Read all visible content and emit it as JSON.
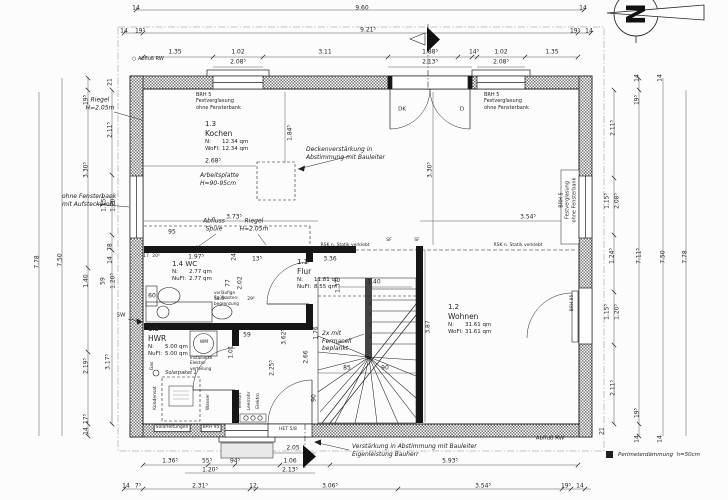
{
  "colors": {
    "ink": "#1f1f1f",
    "hatch": "#7a7a7a",
    "lightwell": "#e9e9e9"
  },
  "north": {
    "label": "N"
  },
  "legend": {
    "text": "Perimeterdämmung  h=50cm"
  },
  "rooms": [
    {
      "num": "1.3",
      "name": "Kochen",
      "inline": false,
      "x": 205,
      "y": 120,
      "rows": [
        [
          "N:",
          "12.34  qm"
        ],
        [
          "WoFl:",
          "12.34  qm"
        ]
      ]
    },
    {
      "num": "1.2",
      "name": "Wohnen",
      "inline": false,
      "x": 448,
      "y": 303,
      "rows": [
        [
          "N:",
          "31.61  qm"
        ],
        [
          "WoFl:",
          "31.61  qm"
        ]
      ]
    },
    {
      "num": "1.4",
      "name": "WC",
      "inline": true,
      "x": 172,
      "y": 260,
      "rows": [
        [
          "N:",
          "2.77  qm"
        ],
        [
          "NuFl:",
          "2.77  qm"
        ]
      ]
    },
    {
      "num": "1.5",
      "name": "HWR",
      "inline": false,
      "x": 148,
      "y": 325,
      "rows": [
        [
          "N:",
          "5.00  qm"
        ],
        [
          "NuFl:",
          "5.00  qm"
        ]
      ]
    },
    {
      "num": "1.1",
      "name": "Flur",
      "inline": false,
      "x": 297,
      "y": 258,
      "rows": [
        [
          "N:",
          "11.81  qm"
        ],
        [
          "NuFl:",
          "8.55  qm"
        ]
      ]
    }
  ],
  "overlays": [
    {
      "t": "14",
      "x": 136,
      "y": 8,
      "c": "d"
    },
    {
      "t": "9.60",
      "x": 362,
      "y": 8,
      "c": "d"
    },
    {
      "t": "14",
      "x": 583,
      "y": 8,
      "c": "d"
    },
    {
      "t": "14",
      "x": 124,
      "y": 31,
      "c": "d"
    },
    {
      "t": "19⁵",
      "x": 140,
      "y": 31,
      "c": "d"
    },
    {
      "t": "9.21⁵",
      "x": 368,
      "y": 30,
      "c": "d"
    },
    {
      "t": "19⁵",
      "x": 575,
      "y": 31,
      "c": "d"
    },
    {
      "t": "14",
      "x": 589,
      "y": 31,
      "c": "d"
    },
    {
      "t": "1.35",
      "x": 175,
      "y": 52,
      "c": "d"
    },
    {
      "t": "1.02",
      "x": 238,
      "y": 52,
      "c": "d"
    },
    {
      "t": "2.08⁵",
      "x": 238,
      "y": 62,
      "c": "d"
    },
    {
      "t": "3.11",
      "x": 325,
      "y": 52,
      "c": "d"
    },
    {
      "t": "1.88⁵",
      "x": 430,
      "y": 52,
      "c": "d"
    },
    {
      "t": "2.13⁵",
      "x": 430,
      "y": 62,
      "c": "d"
    },
    {
      "t": "14⁵",
      "x": 474,
      "y": 52,
      "c": "d"
    },
    {
      "t": "1.02",
      "x": 501,
      "y": 52,
      "c": "d"
    },
    {
      "t": "2.08⁵",
      "x": 501,
      "y": 62,
      "c": "d"
    },
    {
      "t": "1.35",
      "x": 552,
      "y": 52,
      "c": "d"
    },
    {
      "t": "7.78",
      "x": 37,
      "y": 262,
      "c": "dr"
    },
    {
      "t": "7.50",
      "x": 60,
      "y": 260,
      "c": "dr"
    },
    {
      "t": "19⁵",
      "x": 86,
      "y": 100,
      "c": "dr"
    },
    {
      "t": "3.30⁵",
      "x": 86,
      "y": 170,
      "c": "dr"
    },
    {
      "t": "1.40",
      "x": 86,
      "y": 281,
      "c": "dr"
    },
    {
      "t": "2.19⁵",
      "x": 86,
      "y": 366,
      "c": "dr"
    },
    {
      "t": "17⁵",
      "x": 86,
      "y": 419,
      "c": "dr"
    },
    {
      "t": "14",
      "x": 86,
      "y": 431,
      "c": "dr"
    },
    {
      "t": "21",
      "x": 110,
      "y": 82,
      "c": "dr"
    },
    {
      "t": "2.11⁵",
      "x": 110,
      "y": 130,
      "c": "dr"
    },
    {
      "t": "1.15⁵",
      "x": 104,
      "y": 204,
      "c": "dr"
    },
    {
      "t": "1.20⁵",
      "x": 113,
      "y": 204,
      "c": "dr"
    },
    {
      "t": "78",
      "x": 110,
      "y": 247,
      "c": "dr"
    },
    {
      "t": "14",
      "x": 110,
      "y": 260,
      "c": "dr"
    },
    {
      "t": "59",
      "x": 103,
      "y": 281,
      "c": "dr"
    },
    {
      "t": "1.20⁵",
      "x": 113,
      "y": 281,
      "c": "dr"
    },
    {
      "t": "3.17⁵",
      "x": 108,
      "y": 362,
      "c": "dr"
    },
    {
      "t": "14",
      "x": 637,
      "y": 78,
      "c": "dr"
    },
    {
      "t": "14",
      "x": 660,
      "y": 78,
      "c": "dr"
    },
    {
      "t": "19⁵",
      "x": 637,
      "y": 100,
      "c": "dr"
    },
    {
      "t": "2.11⁵",
      "x": 613,
      "y": 128,
      "c": "dr"
    },
    {
      "t": "1.15⁵",
      "x": 607,
      "y": 201,
      "c": "dr"
    },
    {
      "t": "2.08⁵",
      "x": 617,
      "y": 201,
      "c": "dr"
    },
    {
      "t": "1.24⁵",
      "x": 612,
      "y": 256,
      "c": "dr"
    },
    {
      "t": "1.15⁵",
      "x": 607,
      "y": 312,
      "c": "dr"
    },
    {
      "t": "1.20⁵",
      "x": 617,
      "y": 312,
      "c": "dr"
    },
    {
      "t": "2.11⁵",
      "x": 613,
      "y": 388,
      "c": "dr"
    },
    {
      "t": "19⁵",
      "x": 637,
      "y": 413,
      "c": "dr"
    },
    {
      "t": "21",
      "x": 602,
      "y": 431,
      "c": "dr"
    },
    {
      "t": "14",
      "x": 637,
      "y": 439,
      "c": "dr"
    },
    {
      "t": "14",
      "x": 660,
      "y": 439,
      "c": "dr"
    },
    {
      "t": "7.11⁵",
      "x": 639,
      "y": 256,
      "c": "dr"
    },
    {
      "t": "7.50",
      "x": 663,
      "y": 257,
      "c": "dr"
    },
    {
      "t": "7.78",
      "x": 685,
      "y": 257,
      "c": "dr"
    },
    {
      "t": "1.36⁵",
      "x": 170,
      "y": 461,
      "c": "d"
    },
    {
      "t": "55⁵",
      "x": 207,
      "y": 461,
      "c": "d"
    },
    {
      "t": "94⁵",
      "x": 235,
      "y": 461,
      "c": "d"
    },
    {
      "t": "1.06",
      "x": 290,
      "y": 461,
      "c": "d"
    },
    {
      "t": "5.93⁵",
      "x": 450,
      "y": 461,
      "c": "d"
    },
    {
      "t": "1.20⁵",
      "x": 210,
      "y": 470,
      "c": "d"
    },
    {
      "t": "2.13⁵",
      "x": 290,
      "y": 470,
      "c": "d"
    },
    {
      "t": "2.05",
      "x": 293,
      "y": 448,
      "c": "d"
    },
    {
      "t": "14",
      "x": 126,
      "y": 486,
      "c": "d"
    },
    {
      "t": "7⁵",
      "x": 138,
      "y": 486,
      "c": "d"
    },
    {
      "t": "2.31⁵",
      "x": 200,
      "y": 486,
      "c": "d"
    },
    {
      "t": "12",
      "x": 253,
      "y": 486,
      "c": "d"
    },
    {
      "t": "3.06⁵",
      "x": 330,
      "y": 486,
      "c": "d"
    },
    {
      "t": "3.54⁵",
      "x": 483,
      "y": 486,
      "c": "d"
    },
    {
      "t": "19⁵",
      "x": 566,
      "y": 486,
      "c": "d"
    },
    {
      "t": "14",
      "x": 580,
      "y": 486,
      "c": "d"
    },
    {
      "t": "2.68⁵",
      "x": 213,
      "y": 161,
      "c": "d"
    },
    {
      "t": "1.84⁵",
      "x": 290,
      "y": 133,
      "c": "dr"
    },
    {
      "t": "3.30⁵",
      "x": 430,
      "y": 170,
      "c": "dr"
    },
    {
      "t": "3.73⁵",
      "x": 234,
      "y": 217,
      "c": "d"
    },
    {
      "t": "3.54⁵",
      "x": 528,
      "y": 217,
      "c": "d"
    },
    {
      "t": "95",
      "x": 172,
      "y": 232,
      "c": "d"
    },
    {
      "t": "17",
      "x": 146,
      "y": 257,
      "c": "t"
    },
    {
      "t": "20⁵",
      "x": 156,
      "y": 257,
      "c": "t"
    },
    {
      "t": "1.97⁵",
      "x": 196,
      "y": 257,
      "c": "d"
    },
    {
      "t": "24",
      "x": 234,
      "y": 257,
      "c": "dr"
    },
    {
      "t": "13⁵",
      "x": 257,
      "y": 259,
      "c": "d"
    },
    {
      "t": "3.36",
      "x": 330,
      "y": 259,
      "c": "d"
    },
    {
      "t": "77",
      "x": 228,
      "y": 283,
      "c": "dr"
    },
    {
      "t": "2.02",
      "x": 240,
      "y": 283,
      "c": "dr"
    },
    {
      "t": "60",
      "x": 152,
      "y": 296,
      "c": "d"
    },
    {
      "t": "51.5⁵",
      "x": 220,
      "y": 300,
      "c": "t"
    },
    {
      "t": "29⁵",
      "x": 251,
      "y": 300,
      "c": "t"
    },
    {
      "t": "1.37⁵",
      "x": 338,
      "y": 285,
      "c": "dr"
    },
    {
      "t": "3.62⁵",
      "x": 284,
      "y": 337,
      "c": "dr"
    },
    {
      "t": "2.25⁵",
      "x": 272,
      "y": 368,
      "c": "dr"
    },
    {
      "t": "2.66",
      "x": 306,
      "y": 357,
      "c": "dr"
    },
    {
      "t": "1.76",
      "x": 316,
      "y": 333,
      "c": "dr"
    },
    {
      "t": "90",
      "x": 314,
      "y": 398,
      "c": "dr"
    },
    {
      "t": "1.40",
      "x": 374,
      "y": 282,
      "c": "d"
    },
    {
      "t": "85",
      "x": 347,
      "y": 368,
      "c": "d"
    },
    {
      "t": "90",
      "x": 385,
      "y": 368,
      "c": "d"
    },
    {
      "t": "1.01",
      "x": 231,
      "y": 352,
      "c": "dr"
    },
    {
      "t": "59",
      "x": 247,
      "y": 335,
      "c": "d"
    },
    {
      "t": "3.87",
      "x": 428,
      "y": 327,
      "c": "dr"
    },
    {
      "t": "4",
      "x": 370,
      "y": 305,
      "c": "t"
    },
    {
      "t": "3",
      "x": 370,
      "y": 316,
      "c": "t"
    },
    {
      "t": "2",
      "x": 370,
      "y": 327,
      "c": "t"
    },
    {
      "t": "1",
      "x": 370,
      "y": 338,
      "c": "t"
    },
    {
      "t": "Riegel\nH=2.05m",
      "x": 100,
      "y": 104,
      "c": "n"
    },
    {
      "t": "BRH 5\nFestverglasung\nohne Fensterbank",
      "x": 196,
      "y": 92,
      "c": "pl"
    },
    {
      "t": "BRH 5\nFestverglasung\nohne Fensterbank",
      "x": 484,
      "y": 92,
      "c": "pl"
    },
    {
      "t": "BRH 5\nFestverglasung\nohne Fensterbank",
      "x": 568,
      "y": 200,
      "c": "pr"
    },
    {
      "t": "Deckenverstärkung in\nAbstimmung mit Bauleiter",
      "x": 306,
      "y": 146,
      "c": "nl"
    },
    {
      "t": "Arbeitsplatte\nH=90-95cm",
      "x": 200,
      "y": 172,
      "c": "nl"
    },
    {
      "t": "ohne Fensterbank\nmit Aufsteckprofil",
      "x": 62,
      "y": 193,
      "c": "nl"
    },
    {
      "t": "Abfluss\nSpüle",
      "x": 214,
      "y": 225,
      "c": "n"
    },
    {
      "t": "Riegel\nH=2.05m",
      "x": 254,
      "y": 225,
      "c": "n"
    },
    {
      "t": "RSK n. Statik verklebt",
      "x": 345,
      "y": 246,
      "c": "t"
    },
    {
      "t": "RSK n. Statik verklebt",
      "x": 518,
      "y": 246,
      "c": "t"
    },
    {
      "t": "2x mit\nFermacell\nbeplankt",
      "x": 322,
      "y": 330,
      "c": "nl"
    },
    {
      "t": "Verstärkung in Abstimmung mit Bauleiter\nEigenleistung Bauherr",
      "x": 352,
      "y": 443,
      "c": "nl"
    },
    {
      "t": "Solarpaket 1",
      "x": 181,
      "y": 373,
      "c": "ti"
    },
    {
      "t": "○ Abfluß RW",
      "x": 132,
      "y": 56,
      "c": "pl"
    },
    {
      "t": "Abfluß RW",
      "x": 550,
      "y": 439,
      "c": "p"
    },
    {
      "t": "SW",
      "x": 121,
      "y": 316,
      "c": "p"
    },
    {
      "t": "DK",
      "x": 402,
      "y": 110,
      "c": "p"
    },
    {
      "t": "D",
      "x": 462,
      "y": 110,
      "c": "p"
    },
    {
      "t": "SF",
      "x": 389,
      "y": 241,
      "c": "t"
    },
    {
      "t": "SF",
      "x": 417,
      "y": 241,
      "c": "t"
    },
    {
      "t": "WM",
      "x": 204,
      "y": 343,
      "c": "t"
    },
    {
      "t": "BRH 95",
      "x": 573,
      "y": 303,
      "c": "tr"
    },
    {
      "t": "BRH 95",
      "x": 211,
      "y": 428,
      "c": "b"
    },
    {
      "t": "Solarleitungen",
      "x": 172,
      "y": 428,
      "c": "b"
    },
    {
      "t": "HET 5/8",
      "x": 288,
      "y": 430,
      "c": "t"
    },
    {
      "t": "Kondensat",
      "x": 156,
      "y": 398,
      "c": "tr"
    },
    {
      "t": "Gas",
      "x": 153,
      "y": 366,
      "c": "tr"
    },
    {
      "t": "Wasser",
      "x": 209,
      "y": 402,
      "c": "tr"
    },
    {
      "t": "Telefon",
      "x": 241,
      "y": 401,
      "c": "tr"
    },
    {
      "t": "Leerrohr",
      "x": 250,
      "y": 401,
      "c": "tr"
    },
    {
      "t": "Elektro",
      "x": 259,
      "y": 401,
      "c": "tr"
    },
    {
      "t": "vorläufige\nSpülkasten-\nbegrenzung",
      "x": 214,
      "y": 290,
      "c": "tl"
    },
    {
      "t": "installierte\nElektro-\nverteilung",
      "x": 190,
      "y": 355,
      "c": "tl"
    }
  ]
}
